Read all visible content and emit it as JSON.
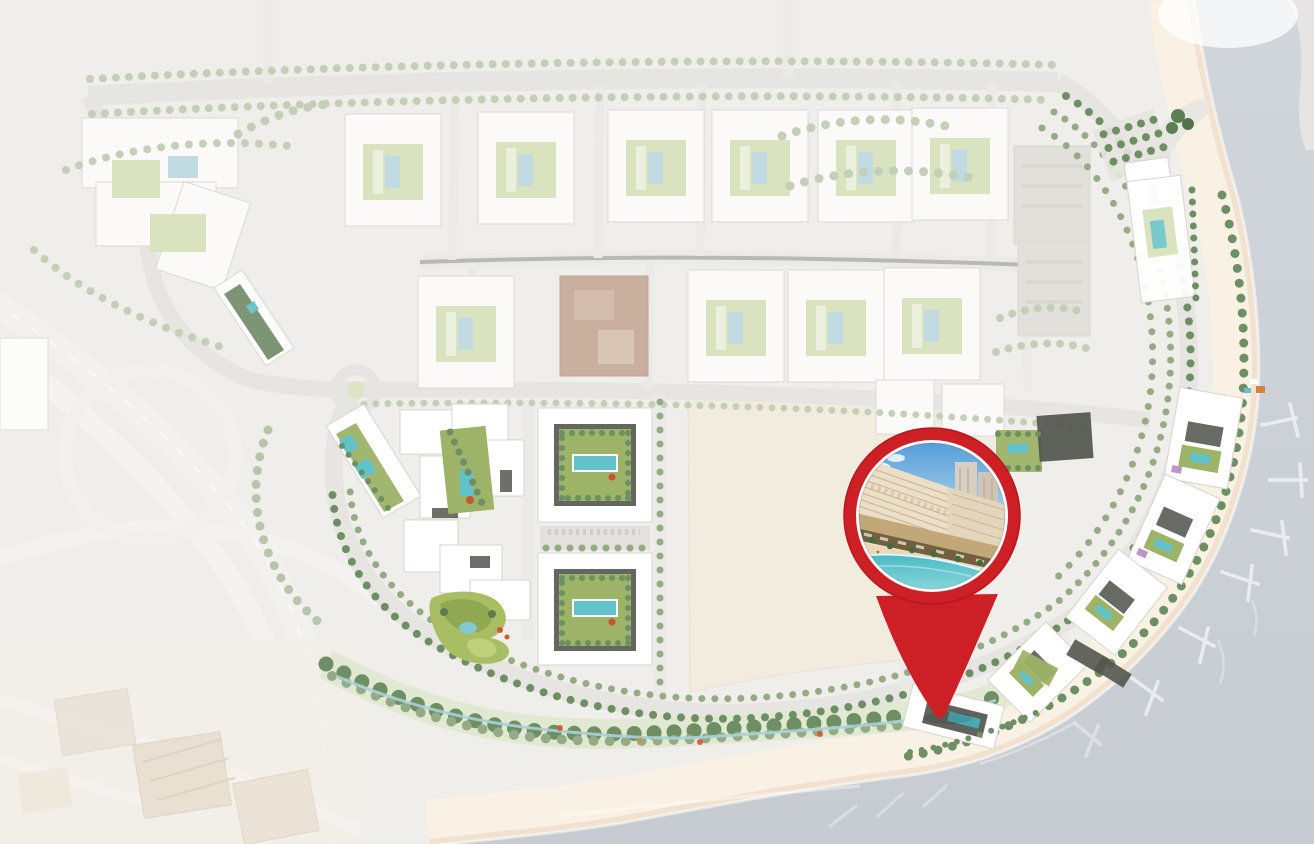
{
  "scene": {
    "title": "Waterfront masterplan site map with location pin",
    "marker": {
      "type": "location-pin",
      "photo_subject": "beachfront mid-rise building rendering with beach and lagoon"
    }
  },
  "colors": {
    "bg": "#efeeeb",
    "water_top": "#d0d6da",
    "water_bottom": "#c6ccd2",
    "beach_sand": "#f8f1e4",
    "beach_wet": "#f1e2d0",
    "sand_lot": "#f2ecdf",
    "road": "#e6e5e1",
    "road_faint": "#eceae7",
    "building_faded": "#fbfaf8",
    "building_stroke": "#dcdad5",
    "building_white": "#ffffff",
    "roof_dark": "#53564e",
    "red_block": "#bfa08c",
    "tree_faint": "#c3cfb6",
    "tree_mid": "#94ab85",
    "tree_dark": "#6d8f63",
    "lawn_pale": "#d9e3c0",
    "lawn_mid": "#9cb368",
    "lawn_bright": "#a9be62",
    "lawn_olive": "#8aa24f",
    "pool_teal": "#62c2cc",
    "pool_pale": "#c2dbe2",
    "pier": "#e9edef",
    "context_roof": "#e6dbcb",
    "pin_red": "#cd1f26",
    "pin_red_dark": "#a8161d",
    "photo_sky_top": "#4f9bd8",
    "photo_sky_bottom": "#cfe6f4",
    "photo_facade": "#ecdfc8",
    "photo_facade_line": "#c0ab87",
    "photo_podium": "#c2a778",
    "photo_storefront": "#72603e",
    "photo_tower": "#d9cfc4",
    "photo_palm": "#3f6e3e",
    "photo_sand": "#ead8b6",
    "photo_water": "#49b9c6",
    "photo_water_light": "#8ad8da",
    "accent_flower": "#cf5a31",
    "accent_purple": "#b48bc2"
  }
}
